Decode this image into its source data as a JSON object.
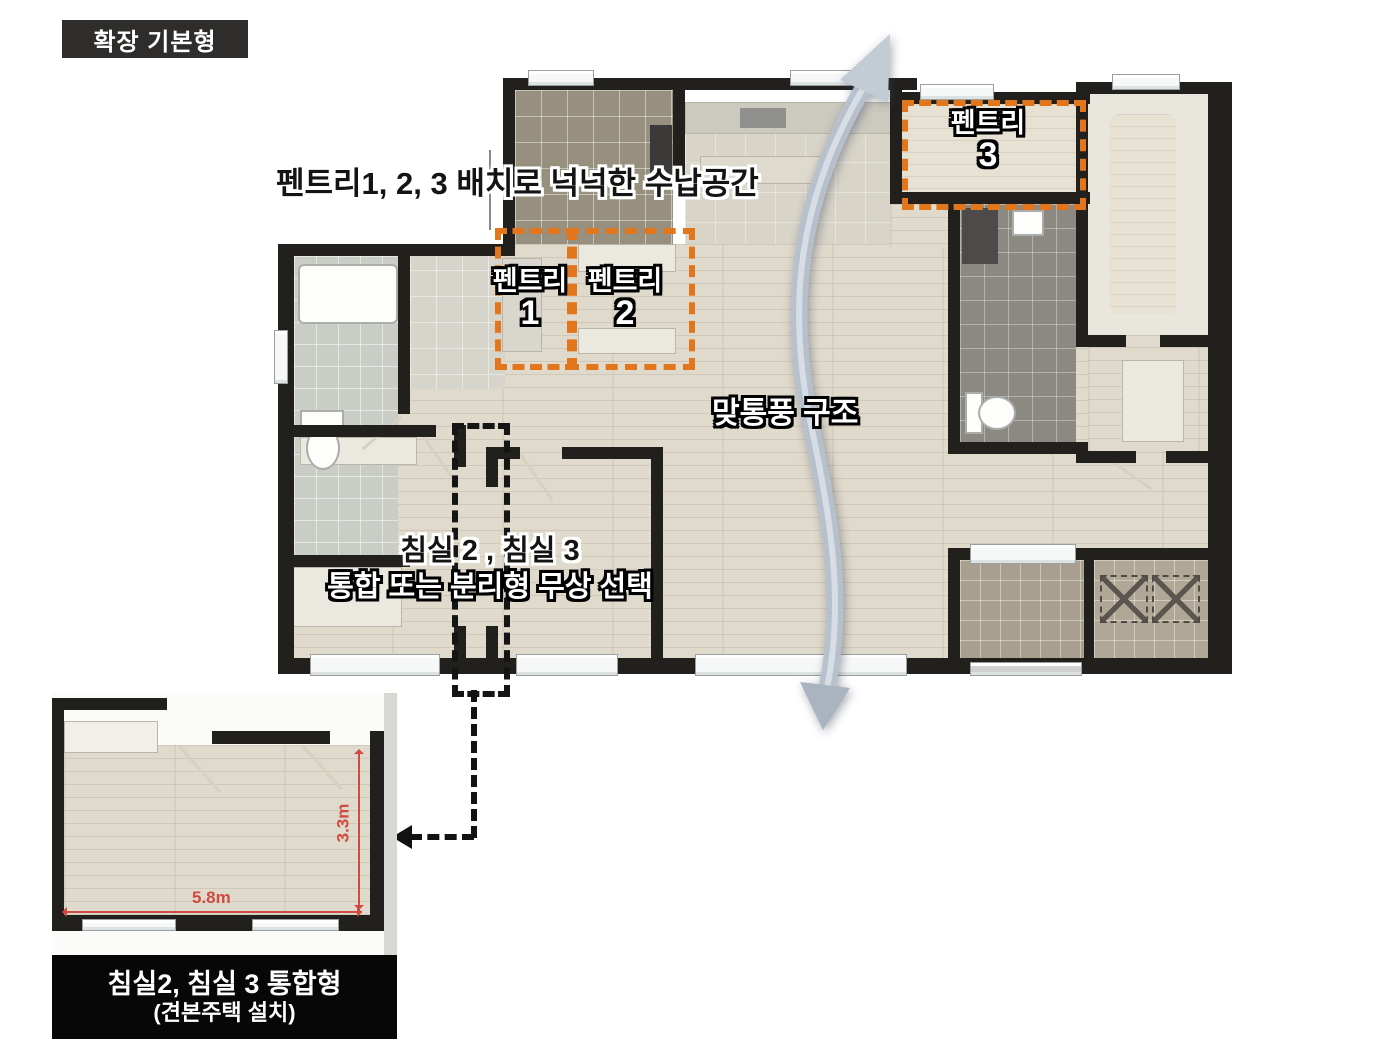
{
  "badge": {
    "label": "확장 기본형"
  },
  "plan": {
    "annotations": {
      "pantry_note": "펜트리1, 2, 3 배치로 넉넉한 수납공간",
      "ventilation_note": "맞통풍 구조",
      "bedroom_note_line1": "침실 2 , 침실 3",
      "bedroom_note_line2": "통합 또는 분리형 무상 선택"
    },
    "pantries": [
      {
        "label": "펜트리",
        "number": "1"
      },
      {
        "label": "펜트리",
        "number": "2"
      },
      {
        "label": "펜트리",
        "number": "3"
      }
    ]
  },
  "inset": {
    "width_label": "5.8m",
    "height_label": "3.3m",
    "caption_line1": "침실2, 침실 3 통합형",
    "caption_line2": "(견본주택 설치)"
  },
  "colors": {
    "accent_orange": "#e2761d",
    "dimension_red": "#cf4a42",
    "wall_black": "#22201d",
    "arrow_gray": "#b7c1cd"
  }
}
